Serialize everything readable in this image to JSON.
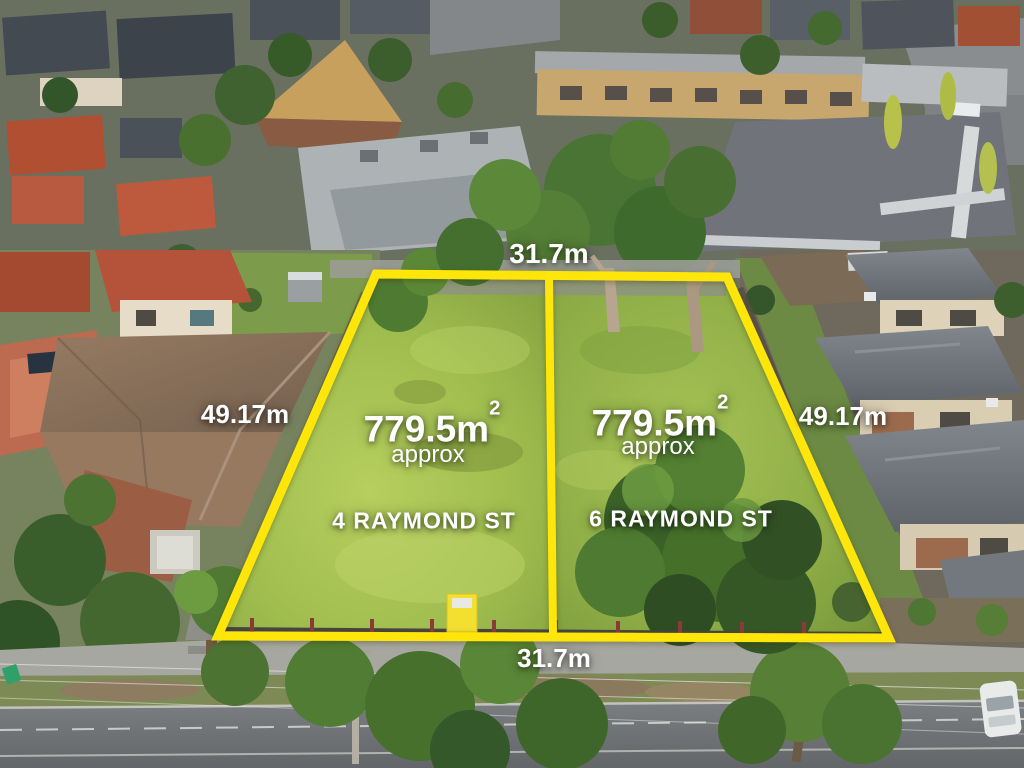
{
  "colors": {
    "boundary": "#FFE60A",
    "label_text": "#FFFFFF"
  },
  "annotations": {
    "top_width": "31.7m",
    "bottom_width": "31.7m",
    "left_depth": "49.17m",
    "right_depth": "49.17m"
  },
  "lots": [
    {
      "address": "4 RAYMOND ST",
      "area_value": "779.5m",
      "area_exponent": "2",
      "area_qualifier": "approx"
    },
    {
      "address": "6 RAYMOND ST",
      "area_value": "779.5m",
      "area_exponent": "2",
      "area_qualifier": "approx"
    }
  ]
}
